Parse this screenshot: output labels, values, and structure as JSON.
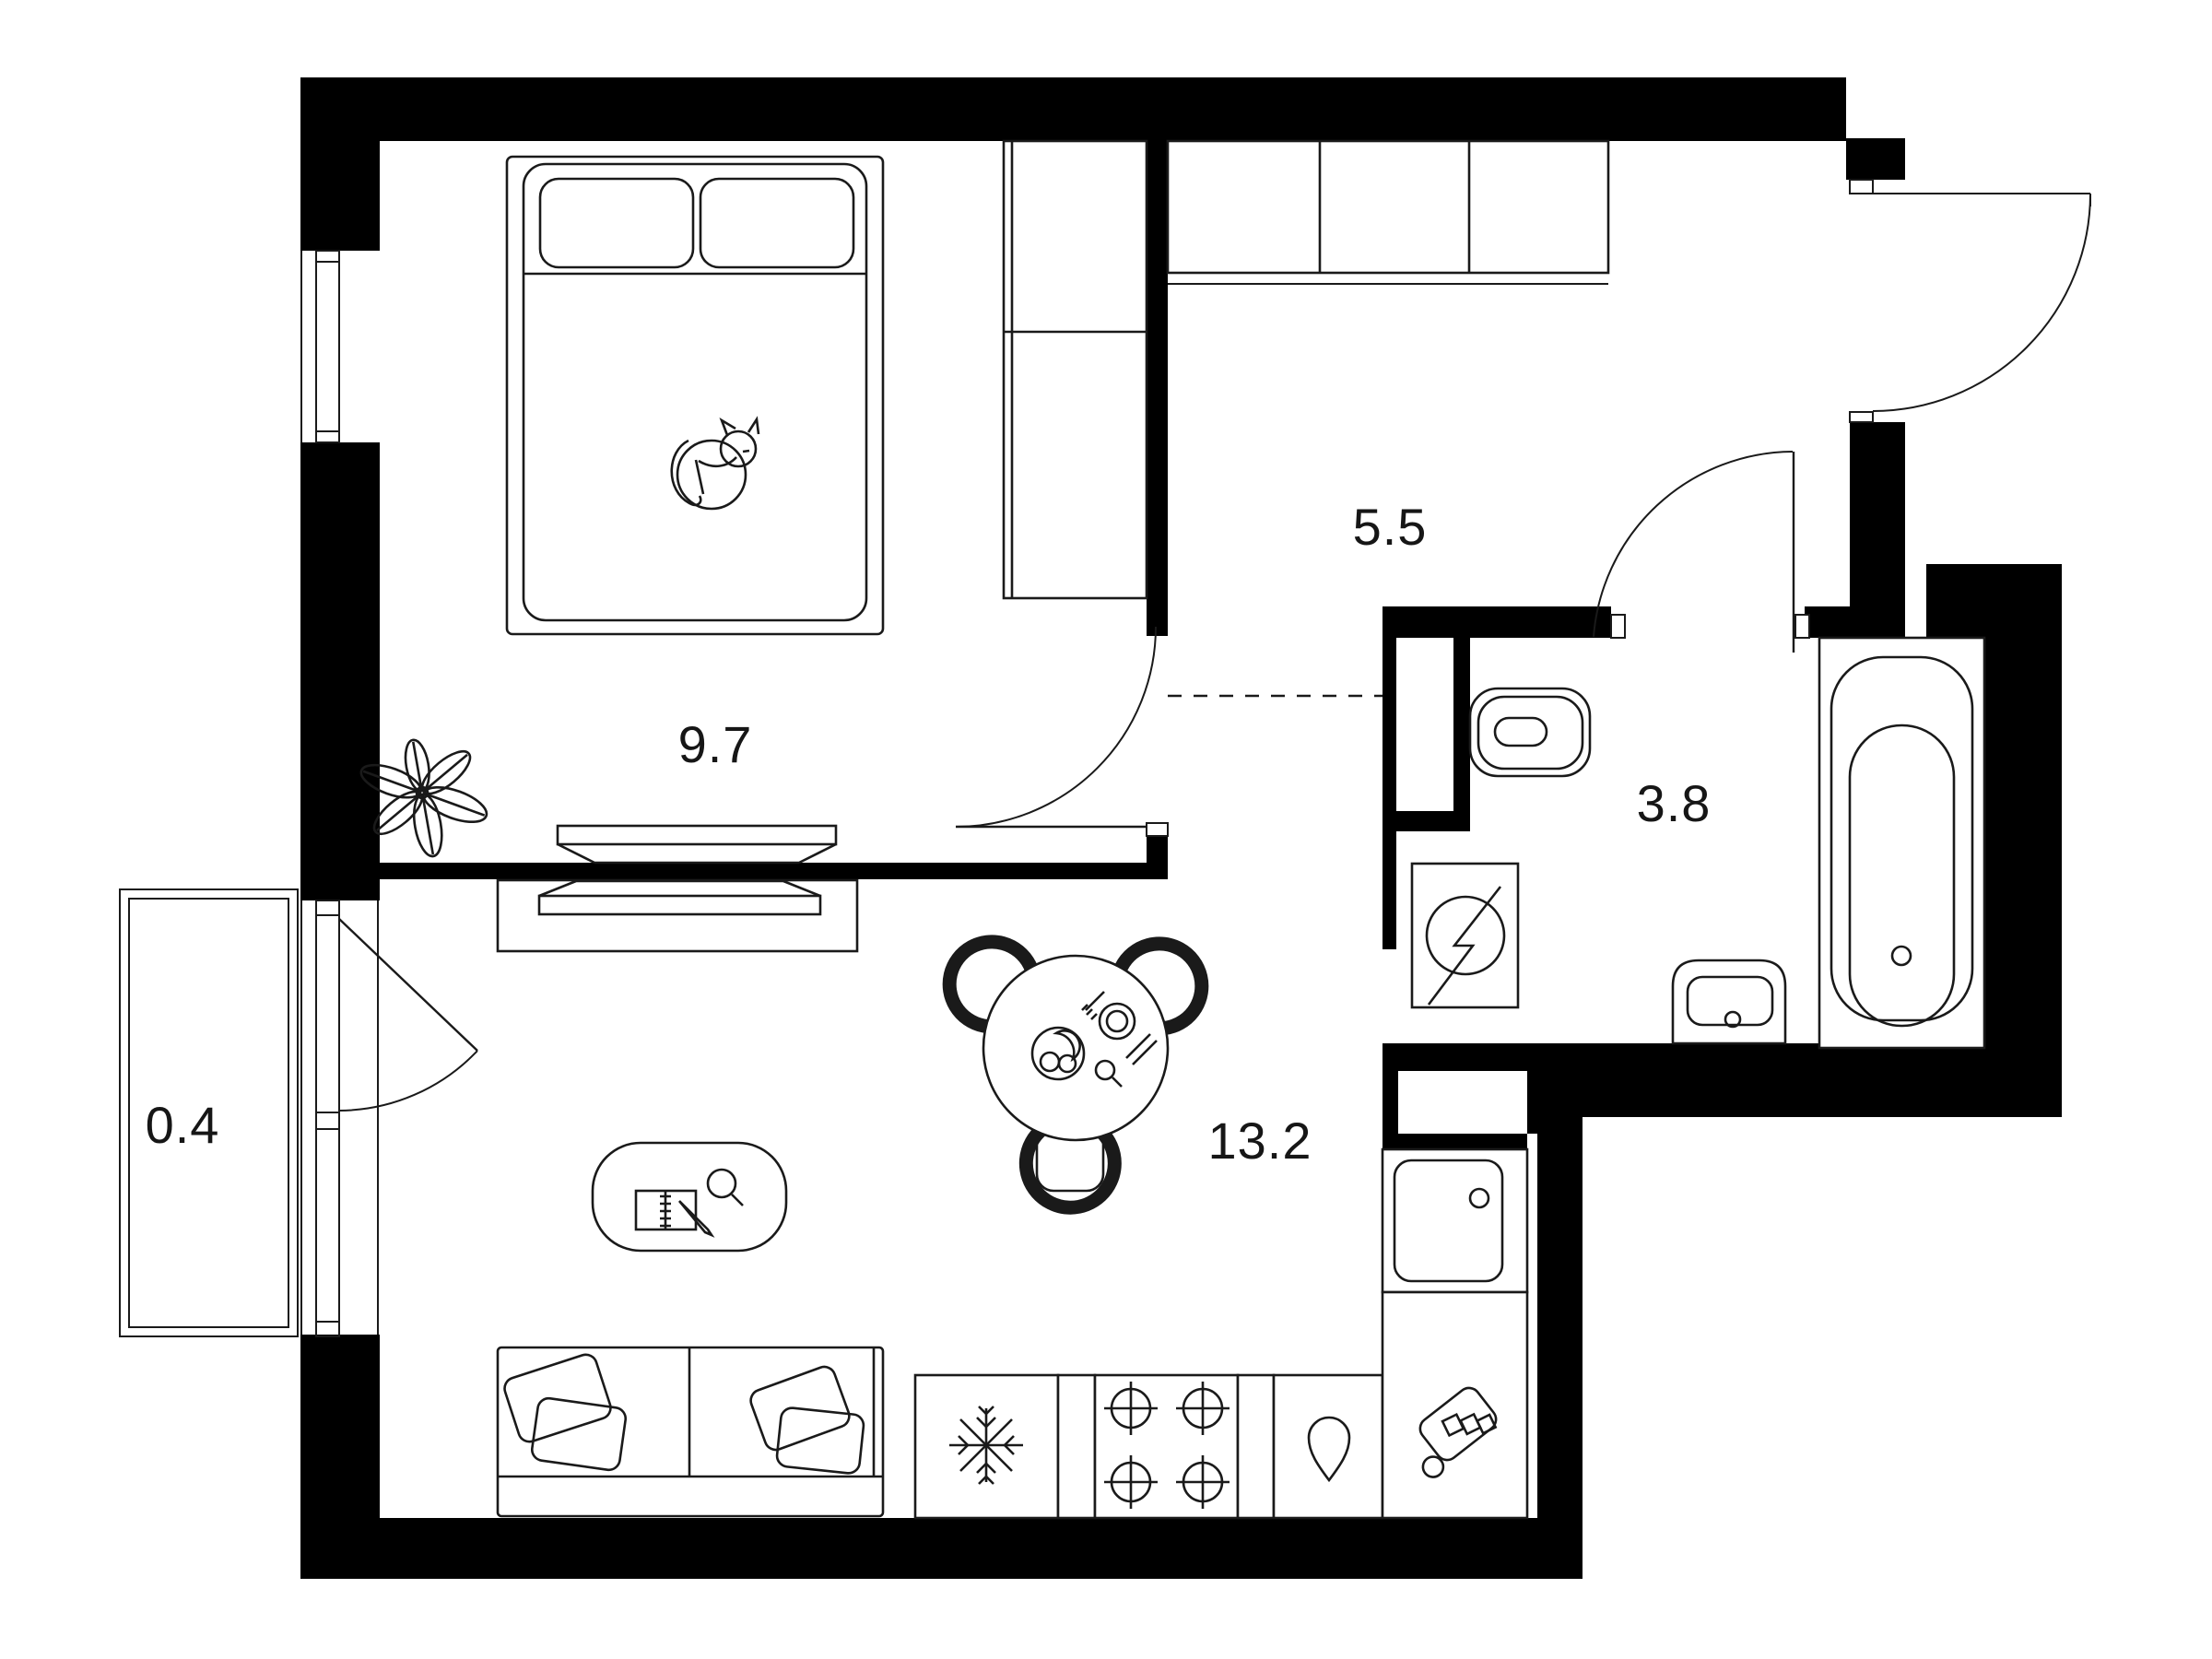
{
  "plan": {
    "title": "studio-apartment-floor-plan",
    "rooms": [
      {
        "id": "bedroom",
        "area_label": "9.7"
      },
      {
        "id": "hallway",
        "area_label": "5.5"
      },
      {
        "id": "bathroom",
        "area_label": "3.8"
      },
      {
        "id": "living_kitchen",
        "area_label": "13.2"
      },
      {
        "id": "balcony",
        "area_label": "0.4"
      }
    ],
    "colors": {
      "walls": "#000000",
      "lines": "#1a1a1a",
      "background": "#ffffff",
      "label_text": "#161616"
    },
    "icons": [
      "cat-icon",
      "plant-icon",
      "snowflake-icon",
      "water-drop-icon",
      "lightning-icon",
      "cutting-board-icon",
      "magnifier-icon",
      "notebook-icon",
      "pencil-icon",
      "burner-icon",
      "faucet-icon"
    ]
  }
}
